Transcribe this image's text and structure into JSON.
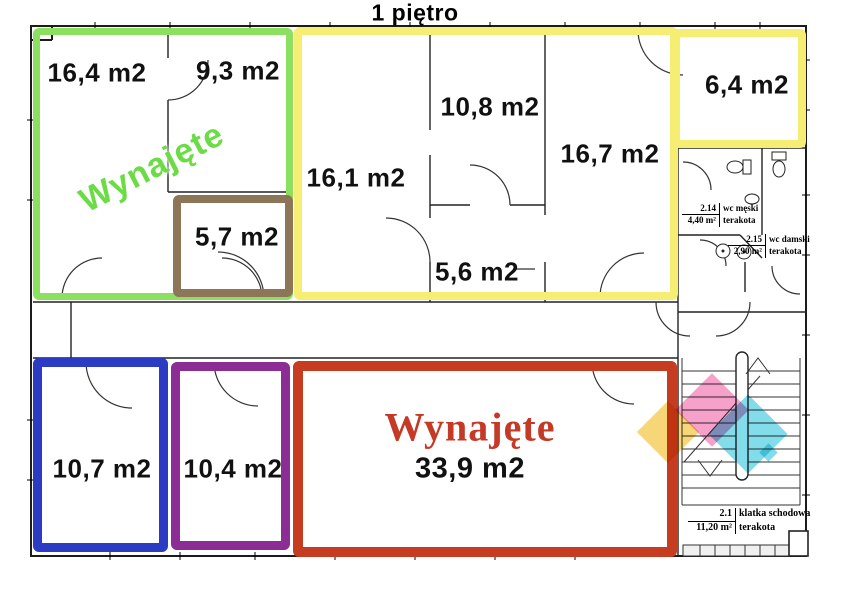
{
  "title": "1 piętro",
  "rooms": {
    "r16_4": "16,4 m2",
    "r9_3": "9,3 m2",
    "r5_7": "5,7 m2",
    "r16_1": "16,1 m2",
    "r10_8": "10,8 m2",
    "r5_6": "5,6 m2",
    "r16_7": "16,7 m2",
    "r6_4": "6,4 m2",
    "r10_7": "10,7 m2",
    "r10_4": "10,4 m2",
    "r33_9": "33,9 m2"
  },
  "status": {
    "rented_upper": "Wynajęte",
    "rented_lower": "Wynajęte"
  },
  "annotations": {
    "wc_male": {
      "number": "2.14",
      "name": "wc męski",
      "area": "4,40 m²",
      "material": "terakota"
    },
    "wc_female": {
      "number": "2.15",
      "name": "wc damski",
      "area": "2,90 m²",
      "material": "terakota"
    },
    "staircase": {
      "number": "2.1",
      "name": "klatka schodowa",
      "area": "11,20 m²",
      "material": "terakota"
    }
  },
  "colors": {
    "zone_green": "#8ce05f",
    "zone_yellow": "#f5ee72",
    "zone_brown": "#8d7557",
    "zone_blue": "#2c3bc4",
    "zone_purple": "#8c2d95",
    "zone_red": "#c63c21",
    "rented_text_green": "#6bdc45",
    "rented_text_red": "#c53a26",
    "watermark_pink": "#f06fae",
    "watermark_cyan": "#2fc4dc",
    "watermark_yellow": "#f2c43c"
  }
}
